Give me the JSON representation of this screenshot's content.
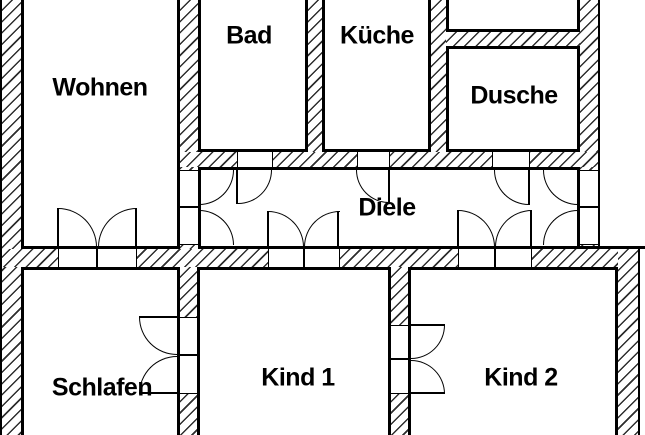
{
  "floorplan": {
    "type": "apartment-floor-plan",
    "colors": {
      "background": "#ffffff",
      "wall_line": "#000000",
      "hatch": "#2e2e2e"
    },
    "rooms": [
      {
        "id": "wohnen",
        "label": "Wohnen"
      },
      {
        "id": "bad",
        "label": "Bad"
      },
      {
        "id": "kueche",
        "label": "Küche"
      },
      {
        "id": "dusche",
        "label": "Dusche"
      },
      {
        "id": "diele",
        "label": "Diele"
      },
      {
        "id": "schlafen",
        "label": "Schlafen"
      },
      {
        "id": "kind1",
        "label": "Kind 1"
      },
      {
        "id": "kind2",
        "label": "Kind 2"
      }
    ]
  }
}
